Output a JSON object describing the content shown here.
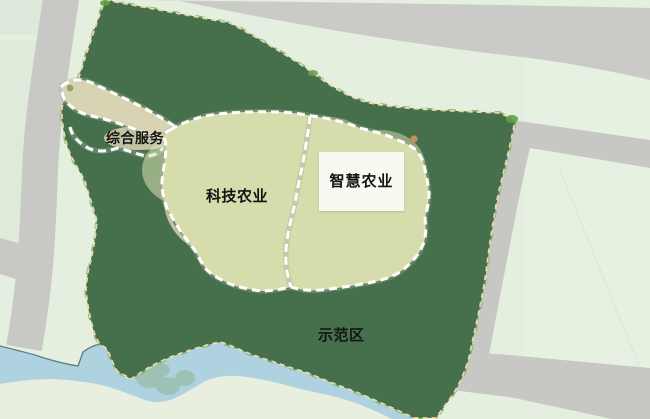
{
  "map": {
    "zones": {
      "comprehensive_services": {
        "label": "综合服务"
      },
      "tech_agriculture": {
        "label": "科技农业"
      },
      "smart_agriculture": {
        "label": "智慧农业"
      },
      "demo_area": {
        "label": "示范区"
      }
    },
    "colors": {
      "background_pale_green": "#e5efdf",
      "farmland_dark_green": "#46704c",
      "inner_zone_light": "#d6dcab",
      "corridor_beige": "#d8d3b3",
      "river_blue": "#abd0df",
      "wetland_teal": "#4d7878",
      "road_gray": "#c9cac5",
      "zone_boundary_dash": "#ffffff",
      "site_boundary_dash": "#ead9a8",
      "label_text": "#141414",
      "label_box_bg": "rgba(255,255,255,0.82)"
    },
    "features": [
      "farmland-grid",
      "wetland-pond",
      "river",
      "greenhouses",
      "road-network",
      "site-boundary-dashed",
      "zone-boundary-dashed",
      "orchard-trees",
      "terraced-field"
    ]
  }
}
